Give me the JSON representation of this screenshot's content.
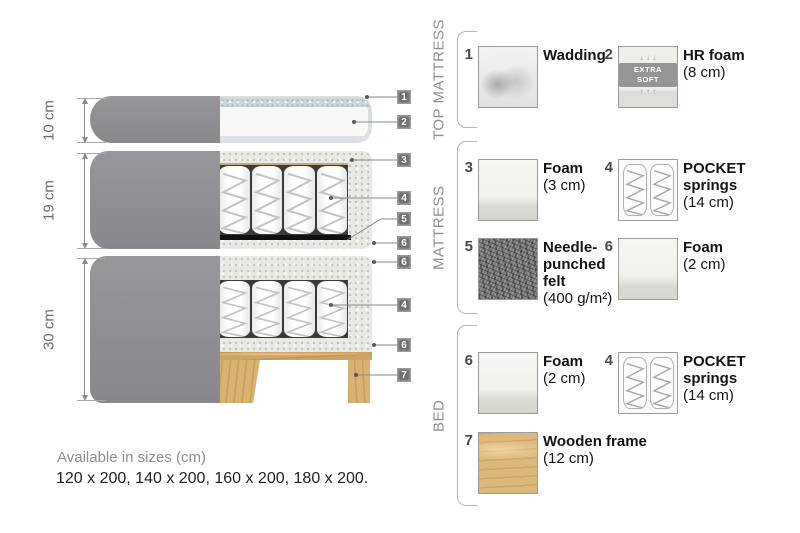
{
  "diagram": {
    "dimensions": [
      "10 cm",
      "19 cm",
      "30 cm"
    ],
    "callouts": [
      "1",
      "2",
      "3",
      "4",
      "5",
      "6",
      "6",
      "4",
      "6",
      "7"
    ]
  },
  "sections": [
    {
      "label": "TOP MATTRESS"
    },
    {
      "label": "MATTRESS"
    },
    {
      "label": "BED"
    }
  ],
  "legend": {
    "items": [
      {
        "num": "1",
        "label": "Wadding",
        "size": ""
      },
      {
        "num": "2",
        "label": "HR foam",
        "size": "(8 cm)"
      },
      {
        "num": "3",
        "label": "Foam",
        "size": "(3 cm)"
      },
      {
        "num": "4",
        "label": "POCKET springs",
        "size": "(14 cm)"
      },
      {
        "num": "5",
        "label": "Needle-punched felt",
        "size": "(400 g/m²)"
      },
      {
        "num": "6",
        "label": "Foam",
        "size": "(2 cm)"
      },
      {
        "num": "6",
        "label": "Foam",
        "size": "(2 cm)"
      },
      {
        "num": "4",
        "label": "POCKET springs",
        "size": "(14 cm)"
      },
      {
        "num": "7",
        "label": "Wooden frame",
        "size": "(12 cm)"
      }
    ],
    "extra_soft": {
      "text": "EXTRA SOFT",
      "arrows_down": "↓ ↓ ↓",
      "arrows_up": "↑ ↑ ↑"
    }
  },
  "footer": {
    "title": "Available in sizes (cm)",
    "sizes": "120 x 200, 140 x 200, 160 x 200, 180 x 200."
  },
  "colors": {
    "cover_gray": "#909094",
    "foam_speckle": "#e9e9e5",
    "wadding_edge": "#ccd6da",
    "wood": "#ddb87b",
    "felt_gray": "#7a7a7a",
    "callout_badge": "#6f6f6f",
    "text_dark": "#141414",
    "text_gray": "#8e8e8e"
  }
}
